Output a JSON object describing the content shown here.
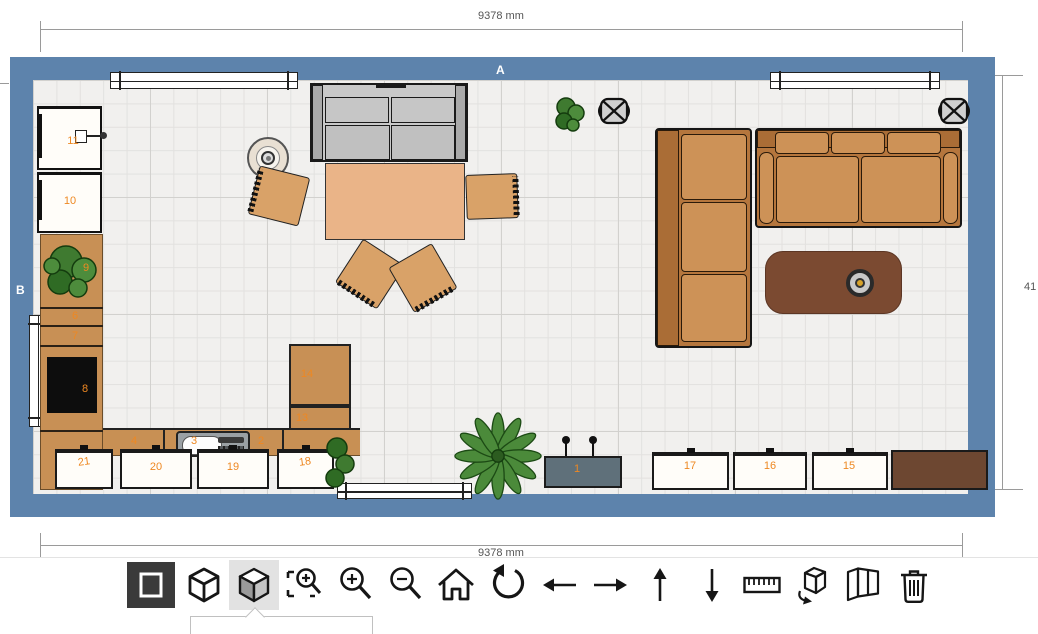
{
  "plan": {
    "wall_labels": {
      "top": "A",
      "left": "B"
    },
    "dimensions": {
      "top": "9378 mm",
      "bottom": "9378 mm",
      "right": "41"
    },
    "item_labels": {
      "tv_bench": "1",
      "counter_right": "2",
      "cooktop": "3",
      "counter_left": "4",
      "drawer_top": "6",
      "drawer_bottom": "7",
      "oven": "8",
      "plant_cabinet": "9",
      "cabinet_10": "10",
      "cabinet_11": "11",
      "tall_cabinet_lower": "13",
      "tall_cabinet_upper": "14",
      "cabinet_15": "15",
      "cabinet_16": "16",
      "cabinet_17": "17",
      "cabinet_18": "18",
      "cabinet_19": "19",
      "cabinet_20": "20",
      "cabinet_21": "21"
    }
  },
  "toolbar": {
    "buttons": [
      {
        "name": "view-2d",
        "icon": "square-outline",
        "active": true
      },
      {
        "name": "view-3d-wireframe",
        "icon": "cube-outline",
        "active": false
      },
      {
        "name": "view-3d-shaded",
        "icon": "cube-solid",
        "active": false,
        "selected": true
      },
      {
        "name": "zoom-to-selection",
        "icon": "magnifier-select",
        "active": false
      },
      {
        "name": "zoom-in",
        "icon": "magnifier-plus",
        "active": false
      },
      {
        "name": "zoom-out",
        "icon": "magnifier-minus",
        "active": false
      },
      {
        "name": "reset-view-home",
        "icon": "house",
        "active": false
      },
      {
        "name": "rotate-view",
        "icon": "rotate-arrow",
        "active": false
      },
      {
        "name": "move-left",
        "icon": "arrow-left",
        "active": false
      },
      {
        "name": "move-right",
        "icon": "arrow-right",
        "active": false
      },
      {
        "name": "move-up",
        "icon": "arrow-up",
        "active": false
      },
      {
        "name": "move-down",
        "icon": "arrow-down",
        "active": false
      },
      {
        "name": "measure",
        "icon": "ruler",
        "active": false
      },
      {
        "name": "rotate-object",
        "icon": "box-rotate",
        "active": false
      },
      {
        "name": "open-doors",
        "icon": "box-open",
        "active": false
      },
      {
        "name": "delete-item",
        "icon": "trash",
        "active": false
      }
    ]
  },
  "colors": {
    "wall": "#5d83ac",
    "floor": "#f1f0ee",
    "item_number": "#ee8822",
    "sofa_brown": "#bd7e45",
    "table_tan": "#eab488",
    "coffee_table": "#7b4a31",
    "toolbar_active_bg": "#3a3a3a",
    "toolbar_selected_bg": "#e2e2e2"
  }
}
